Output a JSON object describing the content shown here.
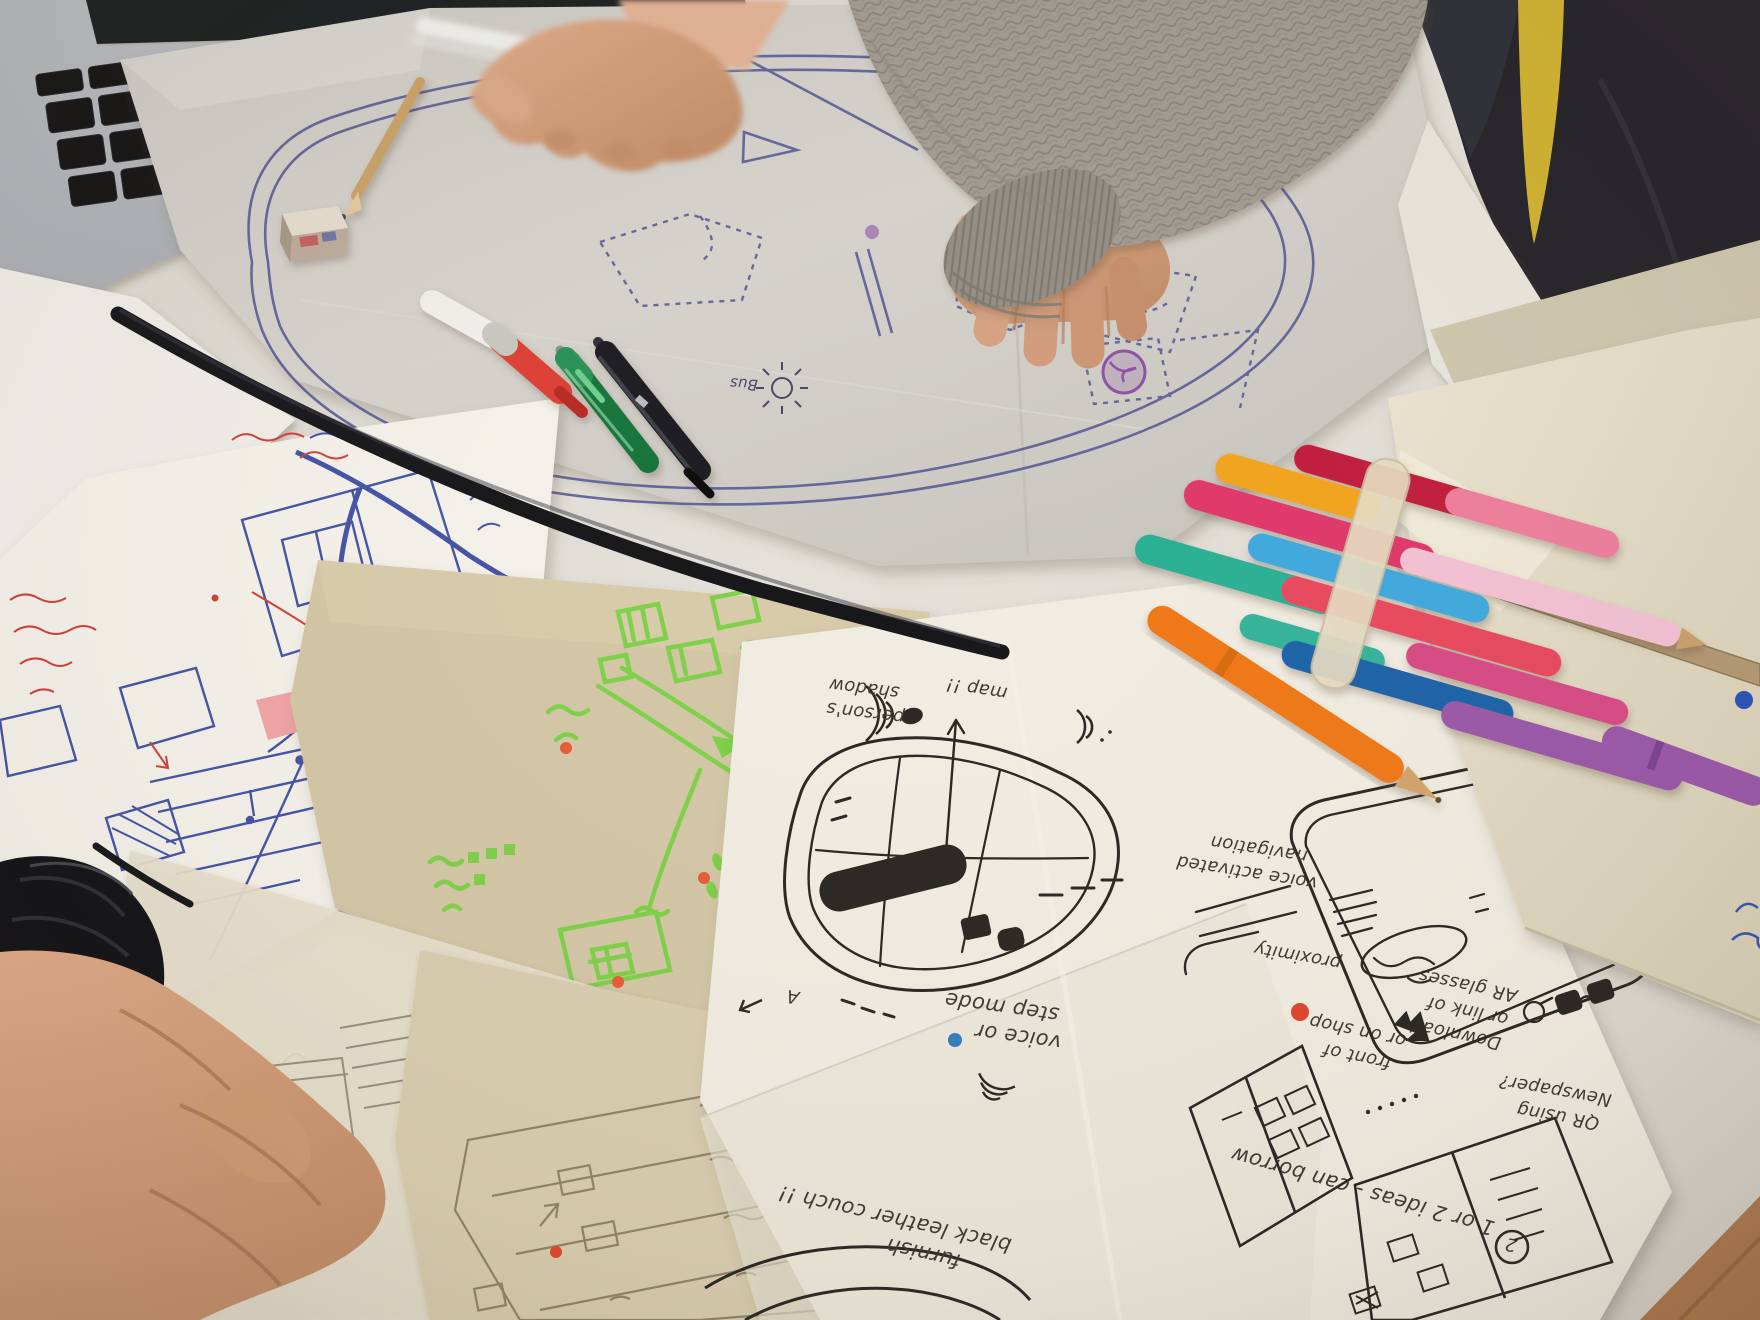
{
  "scene": {
    "type": "photograph",
    "setting": "co-design workshop tabletop with sketched maps, paper wireframes, marker pens and participants' hands"
  },
  "palette": {
    "table": "#e0ddd6",
    "tracing_paper": "#d3d0ca",
    "white_paper": "#f1ece1",
    "kraft_paper": "#d3c6a6",
    "blue_ink": "#4353a4",
    "purple_ink": "#5c5d96",
    "black_ink": "#2a2723",
    "green_marker": "#77d141",
    "red_marker": "#d04038",
    "sweater_gray": "#a09a91",
    "skin": "#d6a183",
    "yellow_strip": "#d9ba32",
    "stamp_purple": "#8d52a4"
  },
  "annotations": {
    "bus": "Bus",
    "person_shadow_1": "person's",
    "person_shadow_2": "shadow",
    "map_note": "map !!",
    "voice_step_1": "voice or",
    "voice_step_2": "step mode",
    "ideas": "1 or 2 ideas - can borrow",
    "ideas_num": "2",
    "front_shop_1": "front of",
    "front_shop_2": "or on shop",
    "download_1": "Download",
    "download_2": "or link of",
    "download_3": "AR glasses",
    "proximity": "proximity",
    "qr_1": "QR using",
    "qr_2": "Newspaper?",
    "voice_nav_1": "voice activated",
    "voice_nav_2": "navigation",
    "couch_1": "furnish",
    "couch_2": "black leather couch !!"
  }
}
